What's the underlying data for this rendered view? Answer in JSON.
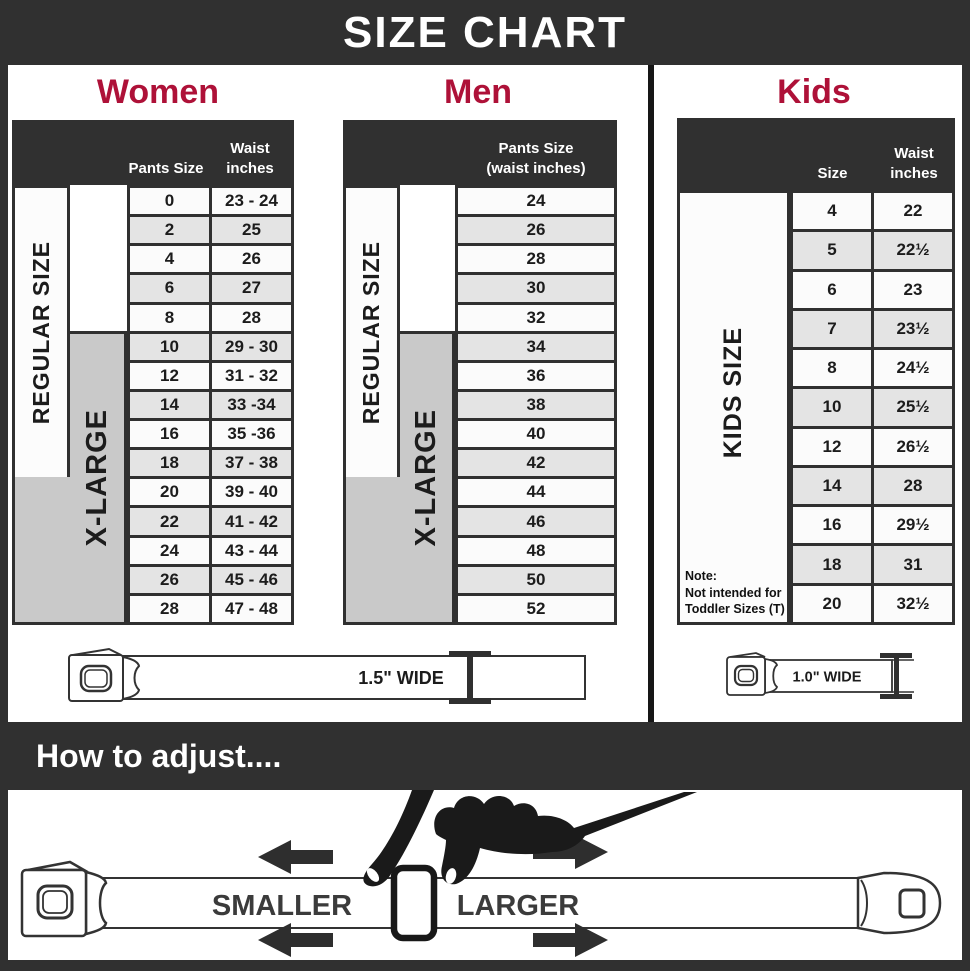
{
  "title": "SIZE CHART",
  "women": {
    "heading": "Women",
    "col1_header": "Pants Size",
    "col2_header": "Waist\ninches",
    "regular_label": "REGULAR SIZE",
    "xlarge_label": "X-LARGE",
    "rows": [
      {
        "size": "0",
        "waist": "23 - 24"
      },
      {
        "size": "2",
        "waist": "25"
      },
      {
        "size": "4",
        "waist": "26"
      },
      {
        "size": "6",
        "waist": "27"
      },
      {
        "size": "8",
        "waist": "28"
      },
      {
        "size": "10",
        "waist": "29 - 30"
      },
      {
        "size": "12",
        "waist": "31 - 32"
      },
      {
        "size": "14",
        "waist": "33 -34"
      },
      {
        "size": "16",
        "waist": "35 -36"
      },
      {
        "size": "18",
        "waist": "37 - 38"
      },
      {
        "size": "20",
        "waist": "39 - 40"
      },
      {
        "size": "22",
        "waist": "41 - 42"
      },
      {
        "size": "24",
        "waist": "43 - 44"
      },
      {
        "size": "26",
        "waist": "45 - 46"
      },
      {
        "size": "28",
        "waist": "47 - 48"
      }
    ],
    "belt_width_label": "1.5\" WIDE"
  },
  "men": {
    "heading": "Men",
    "col_header": "Pants Size\n(waist inches)",
    "regular_label": "REGULAR SIZE",
    "xlarge_label": "X-LARGE",
    "rows": [
      {
        "size": "24"
      },
      {
        "size": "26"
      },
      {
        "size": "28"
      },
      {
        "size": "30"
      },
      {
        "size": "32"
      },
      {
        "size": "34"
      },
      {
        "size": "36"
      },
      {
        "size": "38"
      },
      {
        "size": "40"
      },
      {
        "size": "42"
      },
      {
        "size": "44"
      },
      {
        "size": "46"
      },
      {
        "size": "48"
      },
      {
        "size": "50"
      },
      {
        "size": "52"
      }
    ]
  },
  "kids": {
    "heading": "Kids",
    "col1_header": "Size",
    "col2_header": "Waist\ninches",
    "side_label": "KIDS SIZE",
    "note": "Note:\nNot intended for\nToddler Sizes (T)",
    "rows": [
      {
        "size": "4",
        "waist": "22"
      },
      {
        "size": "5",
        "waist": "22½"
      },
      {
        "size": "6",
        "waist": "23"
      },
      {
        "size": "7",
        "waist": "23½"
      },
      {
        "size": "8",
        "waist": "24½"
      },
      {
        "size": "10",
        "waist": "25½"
      },
      {
        "size": "12",
        "waist": "26½"
      },
      {
        "size": "14",
        "waist": "28"
      },
      {
        "size": "16",
        "waist": "29½"
      },
      {
        "size": "18",
        "waist": "31"
      },
      {
        "size": "20",
        "waist": "32½"
      }
    ],
    "belt_width_label": "1.0\" WIDE"
  },
  "adjust": {
    "heading": "How to adjust....",
    "smaller_label": "SMALLER",
    "larger_label": "LARGER"
  },
  "colors": {
    "bar_dark": "#303030",
    "accent_crimson": "#ae1138",
    "row_light": "#fbfbfb",
    "row_alt": "#e4e4e4",
    "xlarge_gray": "#c9c9c9"
  }
}
